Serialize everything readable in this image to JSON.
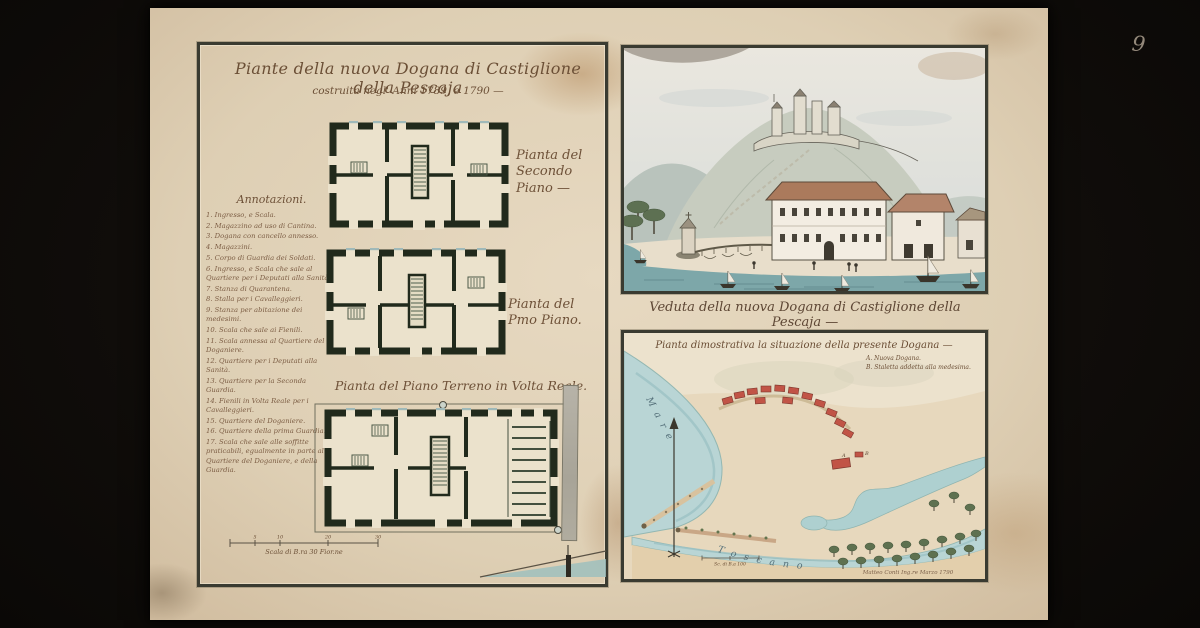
{
  "photo": {
    "margin_number": "9"
  },
  "sheet": {
    "title": "Piante della nuova Dogana di Castiglione della Pescaja",
    "subtitle": "costruita negl' Anni 1789, e 1790 —"
  },
  "annotations": {
    "heading": "Annotazioni.",
    "items": [
      "1. Ingresso, e Scala.",
      "2. Magazzino ad uso di Cantina.",
      "3. Dogana con cancello annesso.",
      "4. Magazzini.",
      "5. Corpo di Guardia dei Soldati.",
      "6. Ingresso, e Scala che sale al Quartiere per i Deputati alla Sanità.",
      "7. Stanza di Quarantena.",
      "8. Stalla per i Cavalleggieri.",
      "9. Stanza per abitazione dei medesimi.",
      "10. Scala che sale ai Fienili.",
      "11. Scala annessa al Quartiere del Doganiere.",
      "12. Quartiere per i Deputati alla Sanità.",
      "13. Quartiere per la Seconda Guardia.",
      "14. Fienili in Volta Reale per i Cavalleggieri.",
      "15. Quartiere del Doganiere.",
      "16. Quartiere della prima Guardia.",
      "17. Scala che sale alle soffitte praticabili, egualmente in parte al Quartiere del Doganiere, e della Guardia."
    ]
  },
  "plans": {
    "second_floor_label": "Pianta del Secondo Piano —",
    "first_floor_label": "Pianta del Pmo Piano.",
    "ground_floor_label": "Pianta del Piano Terreno in Volta Reale.",
    "scale_label": "Scala di B.ra 30 Fior.ne",
    "scale_ticks": [
      "5",
      "10",
      "20",
      "30"
    ]
  },
  "veduta": {
    "caption": "Veduta della nuova Dogana di Castiglione della Pescaja —"
  },
  "map": {
    "title": "Pianta dimostrativa la situazione della presente Dogana —",
    "legend_a": "A. Nuova Dogana.",
    "legend_b": "B. Staletta addetta alla medesima.",
    "marker_a": "A",
    "marker_b": "B",
    "sea_label_1": "Mare",
    "sea_label_2": "Toscano",
    "scale_label": "Sc. di B.a 100",
    "signature": "Matteo Conti Ing.re Marzo 1790"
  },
  "palette": {
    "ink": "#6b4f36",
    "plan_wall": "#212a1c",
    "veduta_sea": "#7da7a9",
    "map_sea": "#b9d5d5",
    "roof": "#ab7a5c",
    "town_red": "#c15446",
    "paper": "#decfb4"
  }
}
